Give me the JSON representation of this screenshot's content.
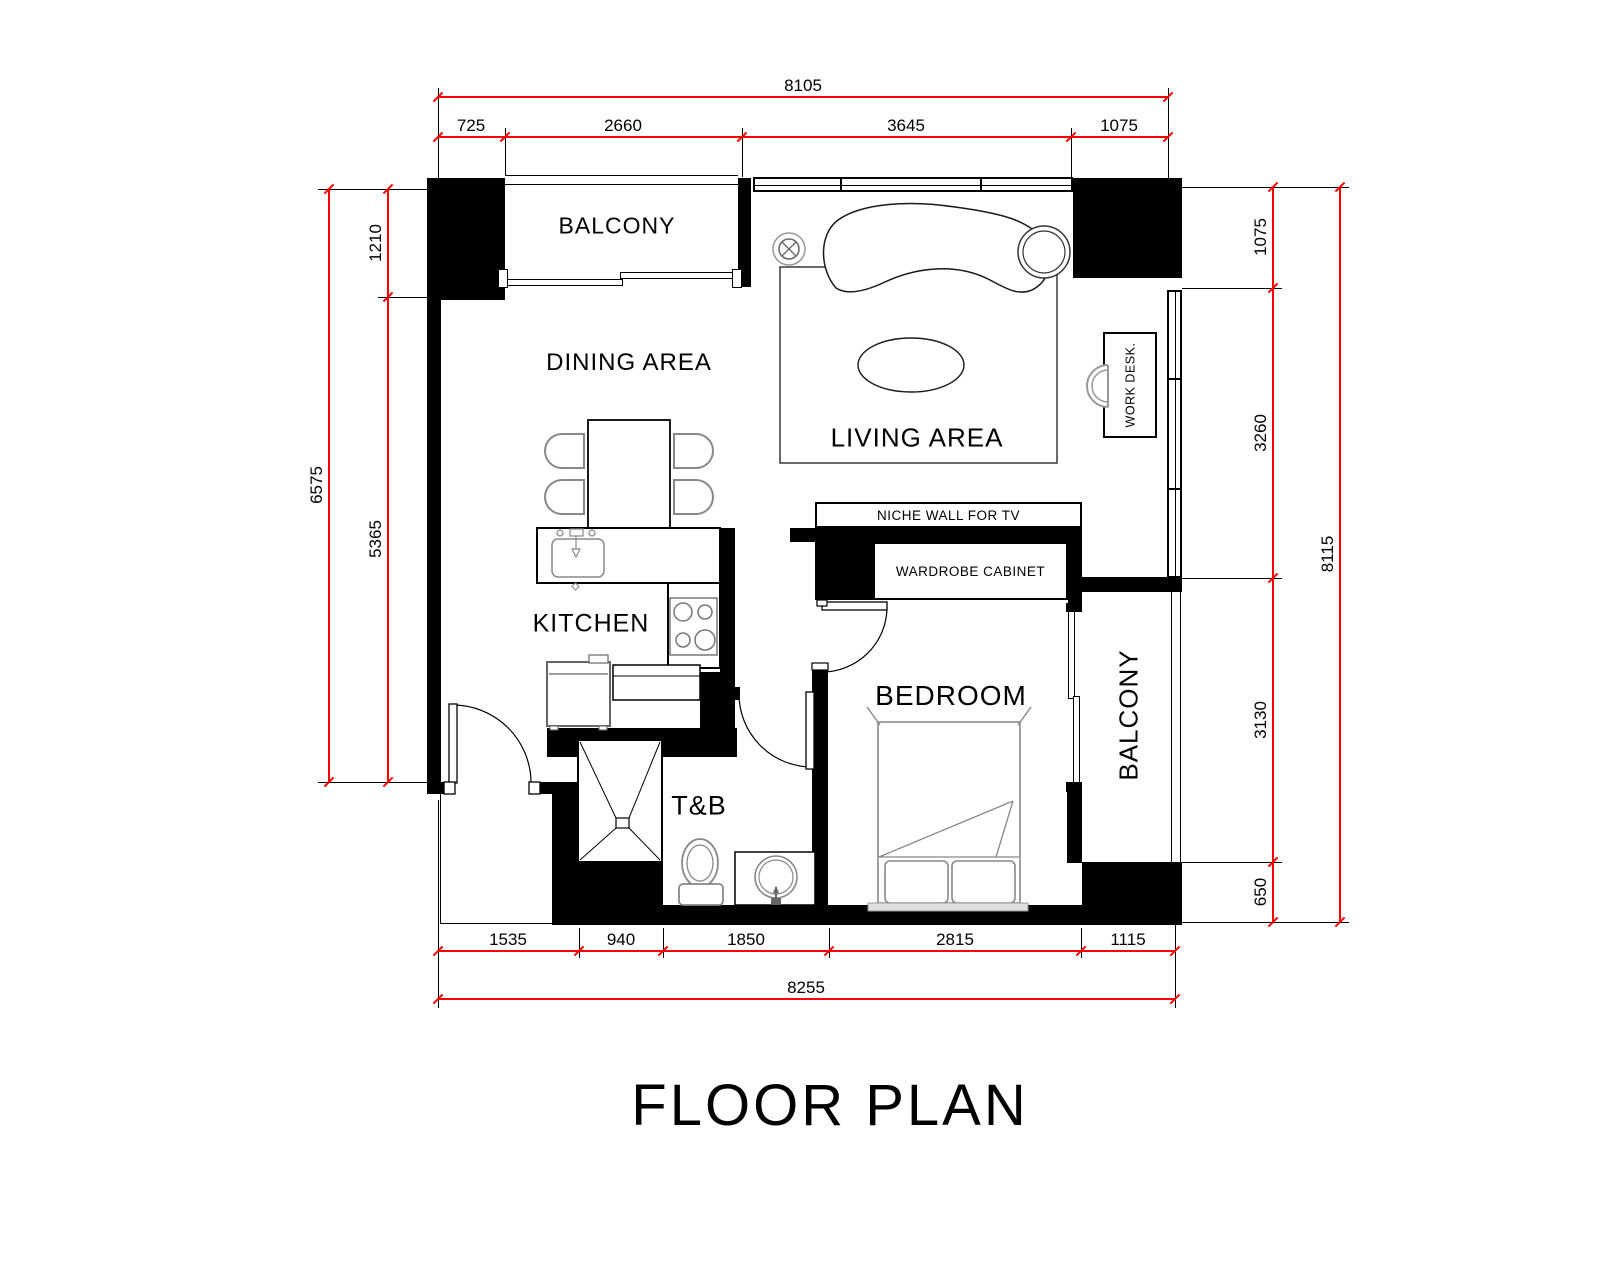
{
  "title": "FLOOR PLAN",
  "rooms": {
    "balcony_top": "BALCONY",
    "dining": "DINING AREA",
    "living": "LIVING AREA",
    "kitchen": "KITCHEN",
    "tb": "T&B",
    "bedroom": "BEDROOM",
    "balcony_right": "BALCONY"
  },
  "annotations": {
    "niche": "NICHE WALL FOR TV",
    "wardrobe": "WARDROBE CABINET",
    "work_desk": "WORK DESK."
  },
  "dimensions": {
    "top": {
      "overall": "8105",
      "segments": [
        "725",
        "2660",
        "3645",
        "1075"
      ]
    },
    "bottom": {
      "overall": "8255",
      "segments": [
        "1535",
        "940",
        "1850",
        "2815",
        "1115"
      ]
    },
    "left": {
      "overall": "6575",
      "segments": [
        "1210",
        "5365"
      ]
    },
    "right": {
      "overall": "8115",
      "segments": [
        "1075",
        "3260",
        "3130",
        "650"
      ]
    }
  },
  "colors": {
    "dimension_line": "#fd0000",
    "wall": "#000000",
    "furniture_outline": "#888888"
  }
}
